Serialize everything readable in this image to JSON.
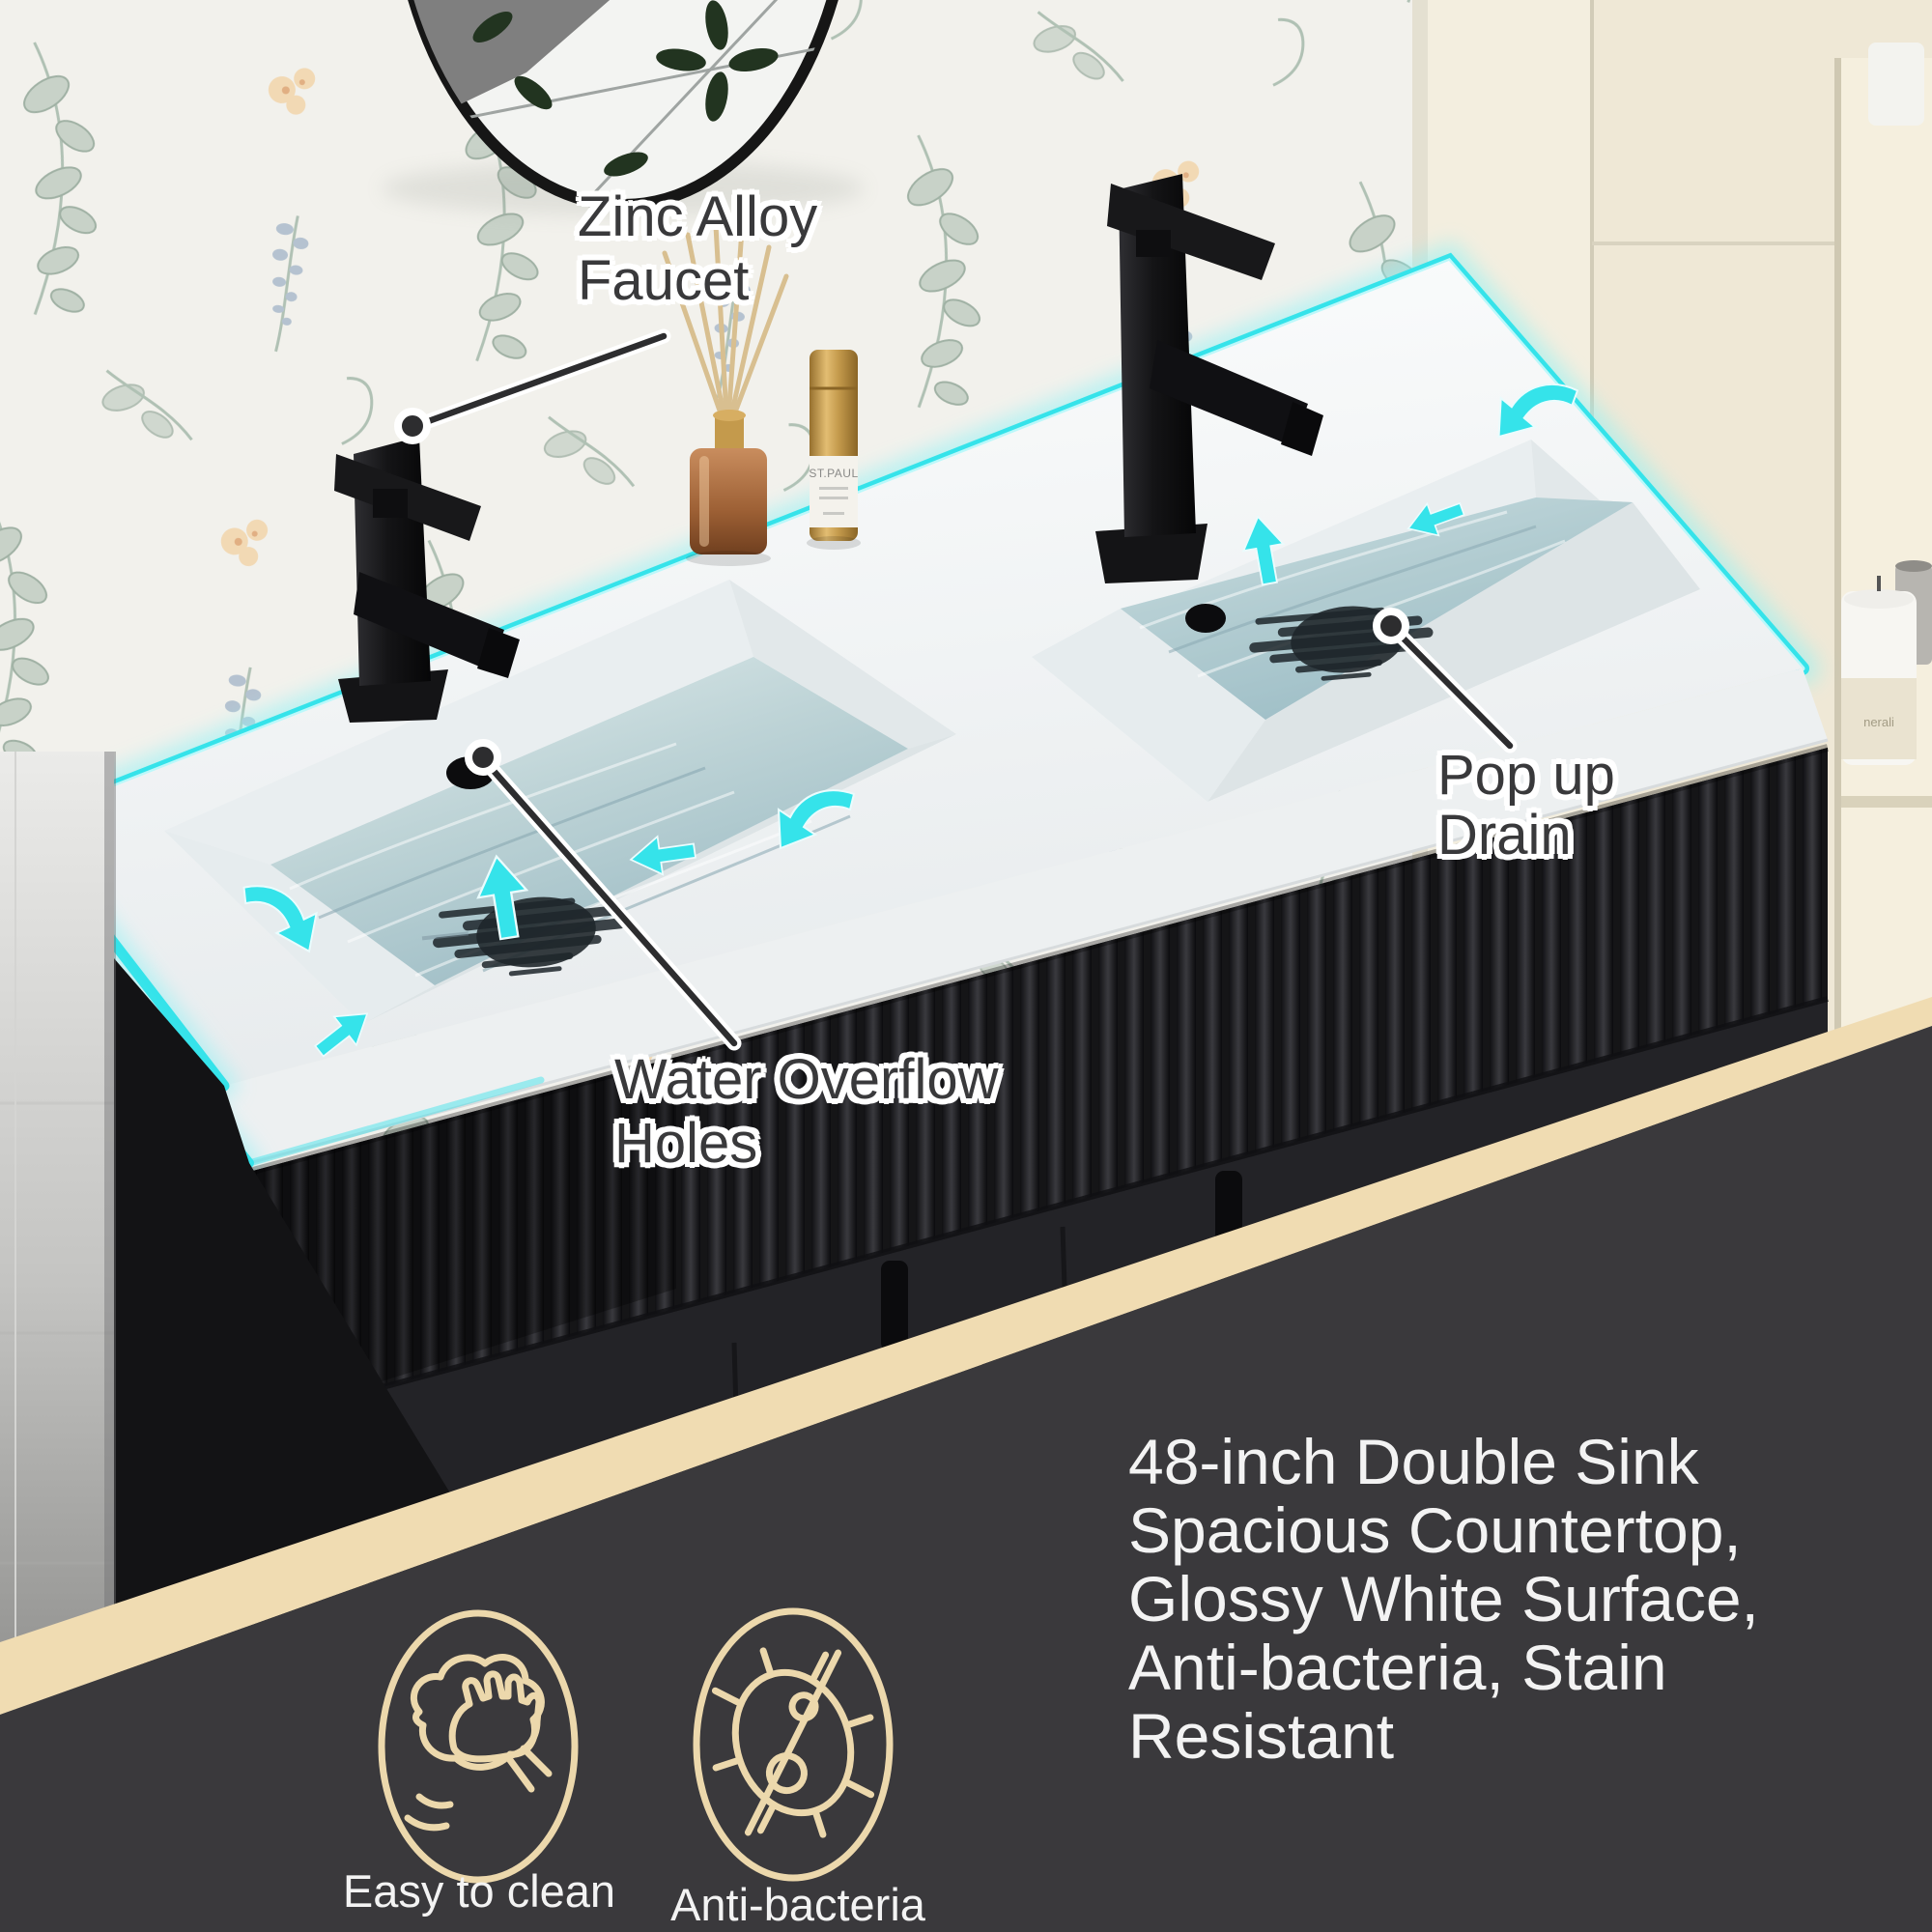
{
  "annotations": {
    "faucet_callout": {
      "lines": [
        "Zinc Alloy",
        "Faucet"
      ]
    },
    "overflow_callout": {
      "lines": [
        "Water Overflow",
        "Holes"
      ]
    },
    "drain_callout": {
      "lines": [
        "Pop up",
        "Drain"
      ]
    }
  },
  "features": [
    {
      "icon": "wipe-clean-icon",
      "label": "Easy to clean"
    },
    {
      "icon": "no-bacteria-icon",
      "label": "Anti-bacteria"
    }
  ],
  "description_lines": [
    "48-inch Double Sink",
    "Spacious Countertop,",
    "Glossy White Surface,",
    "Anti-bacteria, Stain",
    "Resistant"
  ],
  "product_labels": {
    "spray_bottle": "ST.PAUL",
    "candle": "nerali"
  },
  "colors": {
    "accent_cyan": "#35e3ea",
    "band_gold": "#f0dcb2",
    "panel_dark": "#3a393c",
    "icon_tan": "#ecd8ac",
    "callout_ink": "#39393b",
    "counter_white": "#f6f8f9",
    "wall_paper": "#f2f1ec",
    "wall_beige": "#efe8d6",
    "cabinet_dark": "#232327",
    "water_deep": "#a9c4cb"
  }
}
